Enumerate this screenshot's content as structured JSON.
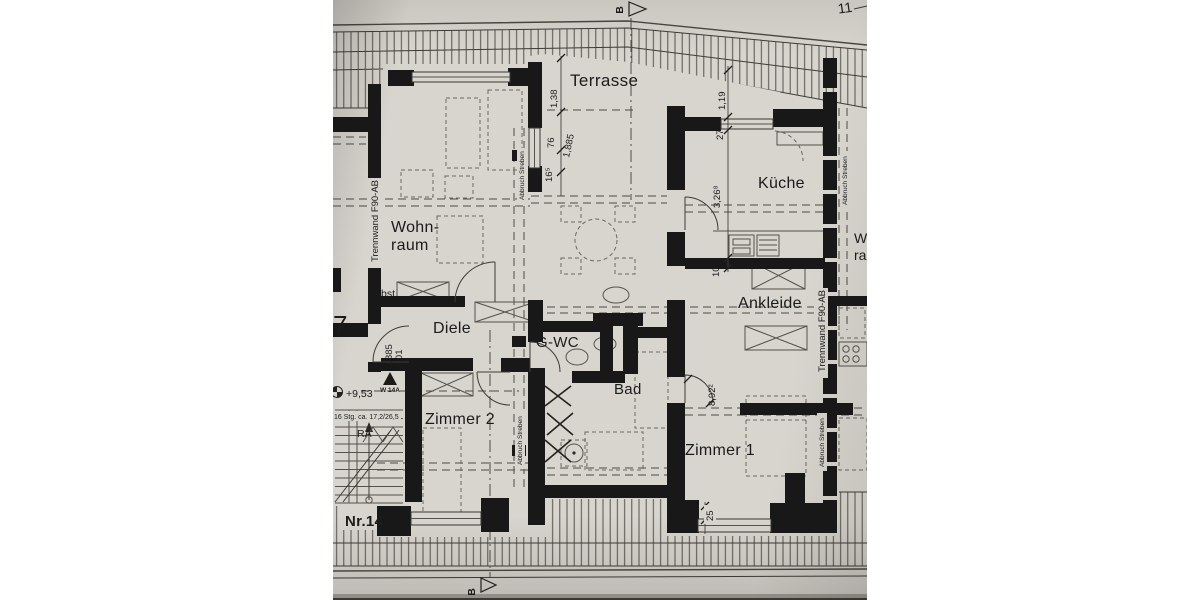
{
  "sheet": {
    "page_number": "11",
    "unit_label": "Nr.14",
    "section_top": "B",
    "section_bottom": "B"
  },
  "rooms": {
    "terrasse": "Terrasse",
    "kueche": "Küche",
    "wohnraum_l1": "Wohn-",
    "wohnraum_l2": "raum",
    "ankleide": "Ankleide",
    "diele": "Diele",
    "gwc": "G-WC",
    "bad": "Bad",
    "zimmer1": "Zimmer 1",
    "zimmer2": "Zimmer 2",
    "abstellraum": "Abst.",
    "neighbor_l1": "W",
    "neighbor_l2": "ra",
    "neighbor_digit": "7"
  },
  "dims": {
    "terr_depth": "1,38",
    "w76": "76",
    "diag": "1,885",
    "w165": "16⁵",
    "terr_right": "1,19",
    "w27": "27",
    "kueche_w": "3,26⁸",
    "w10": "10",
    "door892": "8,92²",
    "w25": "25",
    "door_w": "0,885",
    "door_h": "2,01"
  },
  "notes": {
    "trennwand": "Trennwand F90-AB",
    "abbruch": "Abbruch Streben",
    "level": "+9,53",
    "wall_tag": "W 14A",
    "stairs_note": "16 Stg. ca. 17,2/26,5",
    "stairs_ra": "RA"
  }
}
